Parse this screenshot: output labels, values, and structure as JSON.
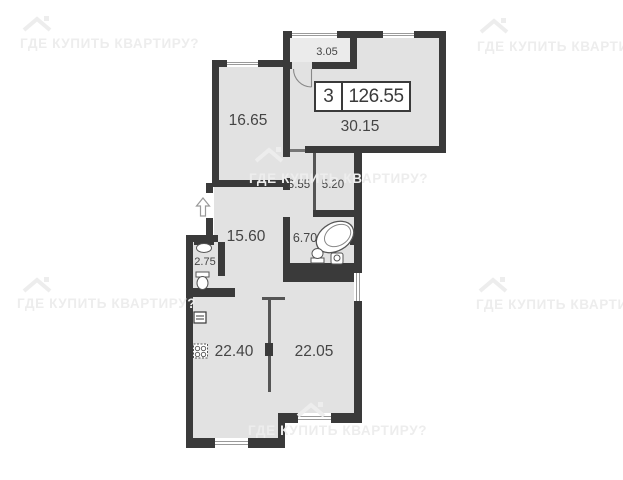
{
  "watermark": {
    "text": "ГДЕ КУПИТЬ КВАРТИРУ?"
  },
  "title_block": {
    "rooms_count": "3",
    "total_area": "126.55"
  },
  "rooms": [
    {
      "name": "balcony",
      "area": "3.05"
    },
    {
      "name": "living-room",
      "area": "30.15"
    },
    {
      "name": "bedroom",
      "area": "16.65"
    },
    {
      "name": "hall",
      "area": "3.55"
    },
    {
      "name": "wardrobe",
      "area": "5.20"
    },
    {
      "name": "corridor",
      "area": "15.60"
    },
    {
      "name": "bathroom",
      "area": "6.70"
    },
    {
      "name": "wc",
      "area": "2.75"
    },
    {
      "name": "kitchen",
      "area": "22.40"
    },
    {
      "name": "living-room-2",
      "area": "22.05"
    }
  ],
  "colors": {
    "wall": "#3a3a3a",
    "floor": "#e2e2e2",
    "watermark": "#ededed"
  }
}
